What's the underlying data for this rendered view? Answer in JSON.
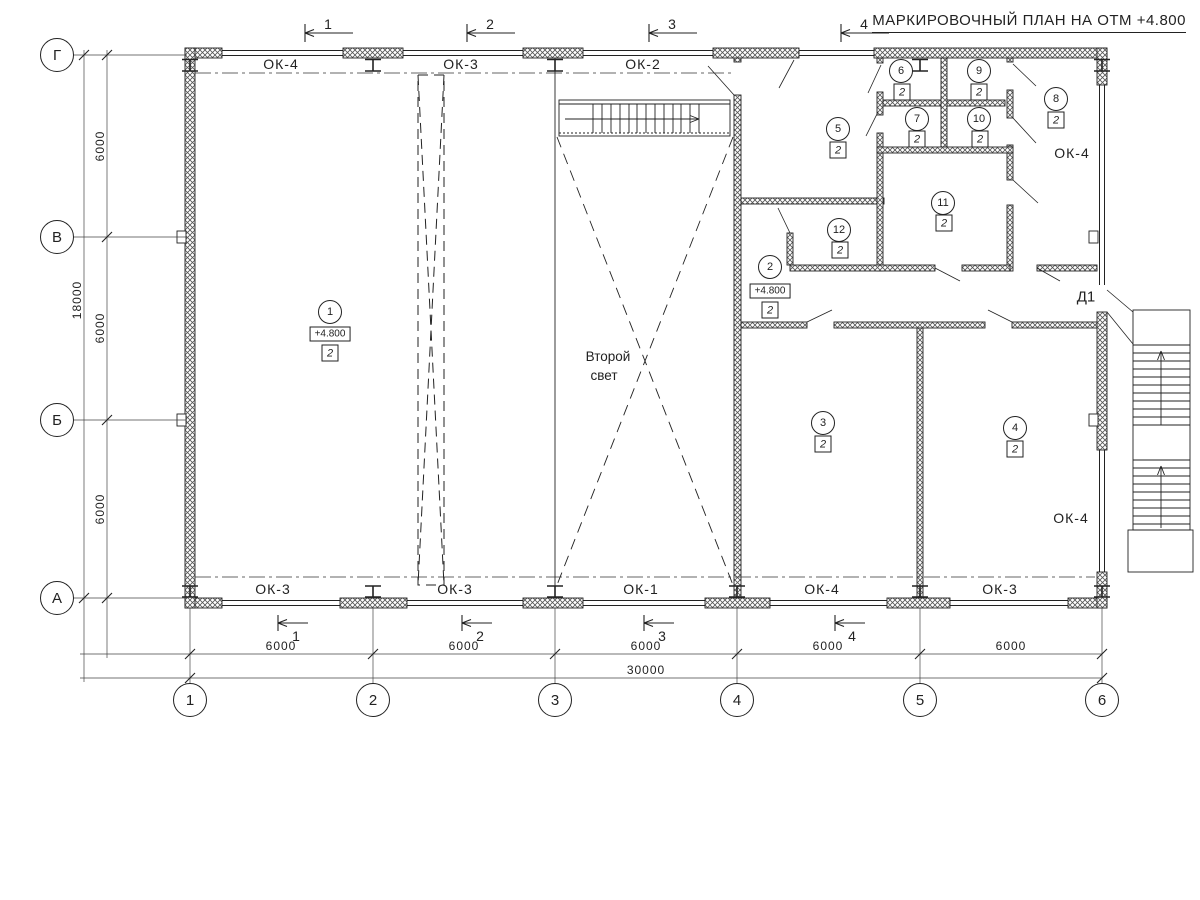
{
  "title": "МАРКИРОВОЧНЫЙ ПЛАН НА ОТМ +4.800",
  "legend": {
    "second_light": "Второй\nсвет",
    "second_light_1": "Второй",
    "second_light_2": "свет",
    "door_label": "Д1"
  },
  "axes": {
    "horizontal": [
      "Г",
      "В",
      "Б",
      "А"
    ],
    "vertical": [
      "1",
      "2",
      "3",
      "4",
      "5",
      "6"
    ]
  },
  "dimensions": {
    "left_segments": [
      "6000",
      "6000",
      "6000"
    ],
    "left_total": "18000",
    "bottom_segments": [
      "6000",
      "6000",
      "6000",
      "6000",
      "6000"
    ],
    "bottom_total": "30000"
  },
  "section_marks": [
    "1",
    "2",
    "3",
    "4"
  ],
  "windows": {
    "top": [
      "ОК-4",
      "ОК-3",
      "ОК-2"
    ],
    "bottom": [
      "ОК-3",
      "ОК-3",
      "ОК-1",
      "ОК-4",
      "ОК-3"
    ],
    "right": [
      "ОК-4",
      "ОК-4"
    ]
  },
  "rooms": [
    {
      "num": "1",
      "type": "2",
      "elev": "+4.800"
    },
    {
      "num": "2",
      "type": "2",
      "elev": "+4.800"
    },
    {
      "num": "3",
      "type": "2"
    },
    {
      "num": "4",
      "type": "2"
    },
    {
      "num": "5",
      "type": "2"
    },
    {
      "num": "6",
      "type": "2"
    },
    {
      "num": "7",
      "type": "2"
    },
    {
      "num": "8",
      "type": "2"
    },
    {
      "num": "9",
      "type": "2"
    },
    {
      "num": "10",
      "type": "2"
    },
    {
      "num": "11",
      "type": "2"
    },
    {
      "num": "12",
      "type": "2"
    }
  ],
  "colors": {
    "line": "#222222",
    "bg": "#ffffff"
  }
}
